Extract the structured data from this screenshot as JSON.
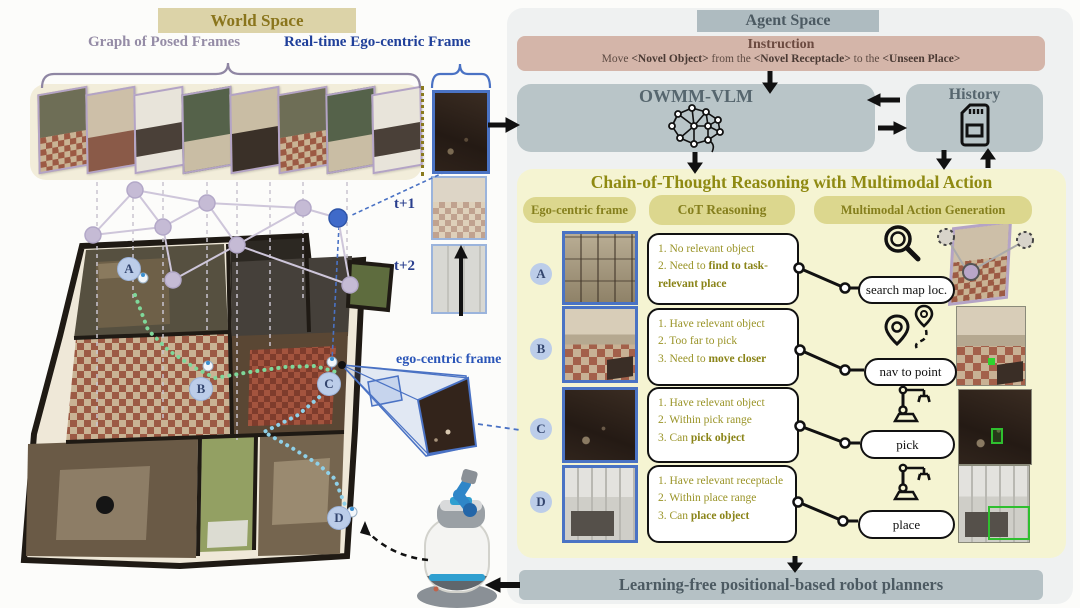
{
  "world_space": {
    "title": "World Space",
    "graph_frames_label": "Graph of Posed Frames",
    "ego_frame_label": "Real-time Ego-centric Frame",
    "timestep_labels": [
      "t+1",
      "t+2"
    ],
    "egocentric_annotation": "ego-centric frame",
    "pose_markers": [
      "A",
      "B",
      "C",
      "D"
    ]
  },
  "agent_space": {
    "title": "Agent Space",
    "instruction": {
      "title": "Instruction",
      "segments": {
        "pre": "Move ",
        "novel_object": "<Novel Object>",
        "mid1": " from the ",
        "novel_receptacle": "<Novel Receptacle>",
        "mid2": " to the ",
        "unseen_place": "<Unseen Place>"
      }
    },
    "owmm_vlm_label": "OWMM-VLM",
    "history_label": "History",
    "cot": {
      "title": "Chain-of-Thought Reasoning with Multimodal Action",
      "columns": [
        "Ego-centric frame",
        "CoT Reasoning",
        "Multimodal Action Generation"
      ],
      "rows": [
        {
          "badge": "A",
          "lines": [
            {
              "pre": "1. No relevant object",
              "bold": ""
            },
            {
              "pre": "2. Need to ",
              "bold": "find to task-relevant place"
            },
            {
              "pre": "",
              "bold": ""
            }
          ],
          "action": "search map loc.",
          "icon": "magnifier-icon"
        },
        {
          "badge": "B",
          "lines": [
            {
              "pre": "1. Have relevant object",
              "bold": ""
            },
            {
              "pre": "2. Too far to pick",
              "bold": ""
            },
            {
              "pre": "3. Need to ",
              "bold": "move closer"
            }
          ],
          "action": "nav to point",
          "icon": "waypoint-icon"
        },
        {
          "badge": "C",
          "lines": [
            {
              "pre": "1. Have relevant object",
              "bold": ""
            },
            {
              "pre": "2. Within pick range",
              "bold": ""
            },
            {
              "pre": "3. Can ",
              "bold": "pick object"
            }
          ],
          "action": "pick",
          "icon": "robot-arm-icon"
        },
        {
          "badge": "D",
          "lines": [
            {
              "pre": "1. Have relevant receptacle",
              "bold": ""
            },
            {
              "pre": "2. Within place range",
              "bold": ""
            },
            {
              "pre": "3. Can ",
              "bold": "place object"
            }
          ],
          "action": "place",
          "icon": "robot-arm-icon"
        }
      ]
    },
    "planner_label": "Learning-free positional-based robot planners"
  },
  "colors": {
    "world_header_bg": "#dcd3a8",
    "agent_header_bg": "#aebbc0",
    "instruction_bg": "#d4b5a9",
    "module_bg": "#b9c5c8",
    "cot_bg": "#f5f4d2",
    "cot_text": "#9a9428",
    "pill_bg": "#dcd78e",
    "ego_frame_border": "#4a73c4",
    "posed_frame_border": "#b3a3c5",
    "marker_bg": "#bccde9",
    "path_green": "#7fd89a",
    "path_blue": "#8fd0e8",
    "action_green": "#2fbf2f"
  }
}
